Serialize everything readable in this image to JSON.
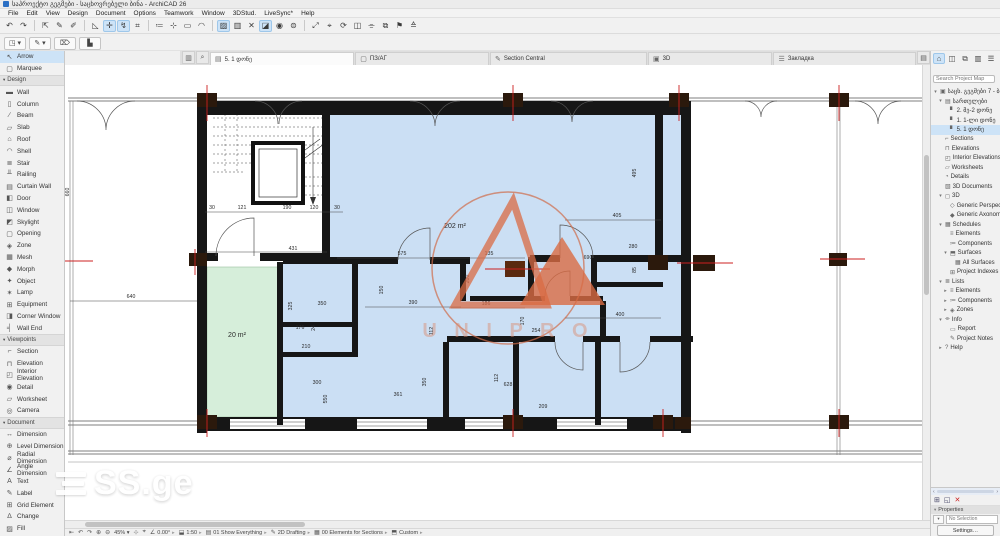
{
  "window": {
    "title": "საპროექტო გეგმები - საცხოვრებელი ბინა - ArchiCAD 26",
    "menus": [
      "File",
      "Edit",
      "View",
      "Design",
      "Document",
      "Options",
      "Teamwork",
      "Window",
      "3DStud.",
      "LiveSync*",
      "Help"
    ]
  },
  "toolbar": {
    "icons": [
      {
        "g": "↶"
      },
      {
        "g": "↷"
      },
      {
        "sep": true
      },
      {
        "g": "⇱"
      },
      {
        "g": "✎"
      },
      {
        "g": "✐"
      },
      {
        "sep": true
      },
      {
        "g": "◺"
      },
      {
        "g": "✛",
        "hl": true
      },
      {
        "g": "↯",
        "hl": true
      },
      {
        "g": "⌗"
      },
      {
        "sep": true
      },
      {
        "g": "≔"
      },
      {
        "g": "⊹"
      },
      {
        "g": "▭"
      },
      {
        "g": "◠"
      },
      {
        "sep": true
      },
      {
        "g": "▨",
        "hl": true
      },
      {
        "g": "▥"
      },
      {
        "g": "✕"
      },
      {
        "g": "◪",
        "hl": true
      },
      {
        "g": "◉"
      },
      {
        "g": "⊜"
      },
      {
        "sep": true
      },
      {
        "g": "⤢"
      },
      {
        "g": "⌖"
      },
      {
        "g": "⟳"
      },
      {
        "g": "◫"
      },
      {
        "g": "⌯"
      },
      {
        "g": "⧉"
      },
      {
        "g": "⚑"
      },
      {
        "g": "≙"
      }
    ]
  },
  "row2": {
    "buttons": [
      "◳ ▾",
      "✎ ▾",
      "⌦",
      "▙"
    ]
  },
  "tabbar": {
    "tabs": [
      {
        "icon": "▤",
        "label": "5. 1 დონე",
        "active": true
      },
      {
        "icon": "▢",
        "label": "ПЗ/АГ",
        "active": false
      },
      {
        "icon": "✎",
        "label": "Section Central",
        "active": false
      },
      {
        "icon": "▣",
        "label": "3D",
        "active": false
      },
      {
        "icon": "☰",
        "label": "Закладка",
        "active": false
      }
    ]
  },
  "toolbox": {
    "groups": [
      {
        "header": null,
        "items": [
          {
            "label": "Arrow",
            "icon": "↖",
            "selected": true
          },
          {
            "label": "Marquee",
            "icon": "▢",
            "selected": false
          }
        ]
      },
      {
        "header": "Design",
        "items": [
          {
            "label": "Wall",
            "icon": "▬"
          },
          {
            "label": "Column",
            "icon": "▯"
          },
          {
            "label": "Beam",
            "icon": "∕"
          },
          {
            "label": "Slab",
            "icon": "▱"
          },
          {
            "label": "Roof",
            "icon": "⌂"
          },
          {
            "label": "Shell",
            "icon": "◠"
          },
          {
            "label": "Stair",
            "icon": "≣"
          },
          {
            "label": "Railing",
            "icon": "╨"
          },
          {
            "label": "Curtain Wall",
            "icon": "▤"
          },
          {
            "label": "Door",
            "icon": "◧"
          },
          {
            "label": "Window",
            "icon": "◫"
          },
          {
            "label": "Skylight",
            "icon": "◩"
          },
          {
            "label": "Opening",
            "icon": "▢"
          },
          {
            "label": "Zone",
            "icon": "◈"
          },
          {
            "label": "Mesh",
            "icon": "▦"
          },
          {
            "label": "Morph",
            "icon": "◆"
          },
          {
            "label": "Object",
            "icon": "✦"
          },
          {
            "label": "Lamp",
            "icon": "✶"
          },
          {
            "label": "Equipment",
            "icon": "⊞"
          },
          {
            "label": "Corner Window",
            "icon": "◨"
          },
          {
            "label": "Wall End",
            "icon": "╡"
          }
        ]
      },
      {
        "header": "Viewpoints",
        "items": [
          {
            "label": "Section",
            "icon": "⌐"
          },
          {
            "label": "Elevation",
            "icon": "⊓"
          },
          {
            "label": "Interior Elevation",
            "icon": "◰"
          },
          {
            "label": "Detail",
            "icon": "◉"
          },
          {
            "label": "Worksheet",
            "icon": "▱"
          },
          {
            "label": "Camera",
            "icon": "◎"
          }
        ]
      },
      {
        "header": "Document",
        "items": [
          {
            "label": "Dimension",
            "icon": "↔"
          },
          {
            "label": "Level Dimension",
            "icon": "⊕"
          },
          {
            "label": "Radial Dimension",
            "icon": "⌀"
          },
          {
            "label": "Angle Dimension",
            "icon": "∠"
          },
          {
            "label": "Text",
            "icon": "A"
          },
          {
            "label": "Label",
            "icon": "✎"
          },
          {
            "label": "Grid Element",
            "icon": "⊞"
          },
          {
            "label": "Change",
            "icon": "∆"
          },
          {
            "label": "Fill",
            "icon": "▨"
          }
        ]
      }
    ]
  },
  "navigator": {
    "search_placeholder": "Search Project Map",
    "icons": [
      "⌂",
      "◫",
      "⧉",
      "▥",
      "☰"
    ],
    "tree": [
      {
        "t": "საცხ. გეგმები 7 - ბინა",
        "l": 0,
        "e": "▾",
        "i": "▣"
      },
      {
        "t": "სართულები",
        "l": 1,
        "e": "▾",
        "i": "▤"
      },
      {
        "t": "2. მე-2 დონე",
        "l": 2,
        "e": "",
        "i": "▘"
      },
      {
        "t": "1. 1-ლი დონე",
        "l": 2,
        "e": "",
        "i": "▘"
      },
      {
        "t": "5. 1 დონე",
        "l": 2,
        "e": "",
        "i": "▘",
        "sel": true
      },
      {
        "t": "Sections",
        "l": 1,
        "e": "",
        "i": "⌐"
      },
      {
        "t": "Elevations",
        "l": 1,
        "e": "",
        "i": "⊓"
      },
      {
        "t": "Interior Elevations",
        "l": 1,
        "e": "",
        "i": "◰"
      },
      {
        "t": "Worksheets",
        "l": 1,
        "e": "",
        "i": "▱"
      },
      {
        "t": "Details",
        "l": 1,
        "e": "",
        "i": "◔"
      },
      {
        "t": "3D Documents",
        "l": 1,
        "e": "",
        "i": "▧"
      },
      {
        "t": "3D",
        "l": 1,
        "e": "▾",
        "i": "◻"
      },
      {
        "t": "Generic Perspective",
        "l": 2,
        "e": "",
        "i": "◇"
      },
      {
        "t": "Generic Axonometry",
        "l": 2,
        "e": "",
        "i": "◆"
      },
      {
        "t": "Schedules",
        "l": 1,
        "e": "▾",
        "i": "▦"
      },
      {
        "t": "Elements",
        "l": 2,
        "e": "",
        "i": "≡"
      },
      {
        "t": "Components",
        "l": 2,
        "e": "",
        "i": "≔"
      },
      {
        "t": "Surfaces",
        "l": 2,
        "e": "▾",
        "i": "⬒"
      },
      {
        "t": "All Surfaces",
        "l": 3,
        "e": "",
        "i": "▦"
      },
      {
        "t": "Project Indexes",
        "l": 2,
        "e": "",
        "i": "⊞"
      },
      {
        "t": "Lists",
        "l": 1,
        "e": "▾",
        "i": "≣"
      },
      {
        "t": "Elements",
        "l": 2,
        "e": "▸",
        "i": "≡"
      },
      {
        "t": "Components",
        "l": 2,
        "e": "▸",
        "i": "≔"
      },
      {
        "t": "Zones",
        "l": 2,
        "e": "▸",
        "i": "◈"
      },
      {
        "t": "Info",
        "l": 1,
        "e": "▾",
        "i": "⌯"
      },
      {
        "t": "Report",
        "l": 2,
        "e": "",
        "i": "▭"
      },
      {
        "t": "Project Notes",
        "l": 2,
        "e": "",
        "i": "✎"
      },
      {
        "t": "Help",
        "l": 1,
        "e": "▸",
        "i": "?"
      }
    ]
  },
  "side_panel": {
    "icons": [
      "⊞",
      "◱",
      "✕"
    ],
    "header": "Properties",
    "field": "No Selection",
    "button": "Settings…"
  },
  "statusbar": {
    "nav_icons": [
      "⇤",
      "↶",
      "↷",
      "⊕",
      "⊖"
    ],
    "zoom": "45%",
    "mid_icons": [
      "⊹",
      "⌖"
    ],
    "segments": [
      {
        "icon": "∠",
        "label": "0.00°"
      },
      {
        "icon": "⬓",
        "label": "1:50"
      },
      {
        "icon": "▤",
        "label": "01 Show Everything"
      },
      {
        "icon": "✎",
        "label": "2D Drafting"
      },
      {
        "icon": "▦",
        "label": "00 Elements for Sections"
      },
      {
        "icon": "⬒",
        "label": "Custom"
      }
    ]
  },
  "watermarks": {
    "logo_text": "SS.ge",
    "circle_text": "U N I  P R O"
  },
  "plan": {
    "room_colors": {
      "blue": "#cbdff4",
      "green": "#d6eeda"
    },
    "dims": [
      {
        "t": "660",
        "x": 4,
        "y": 127,
        "r": 1
      },
      {
        "t": "640",
        "x": 66,
        "y": 233
      },
      {
        "t": "30",
        "x": 147,
        "y": 144
      },
      {
        "t": "121",
        "x": 177,
        "y": 144
      },
      {
        "t": "190",
        "x": 222,
        "y": 144
      },
      {
        "t": "120",
        "x": 249,
        "y": 144
      },
      {
        "t": "30",
        "x": 272,
        "y": 144
      },
      {
        "t": "431",
        "x": 228,
        "y": 185
      },
      {
        "t": "575",
        "x": 337,
        "y": 190
      },
      {
        "t": "135",
        "x": 424,
        "y": 190
      },
      {
        "t": "202 m²",
        "x": 390,
        "y": 163,
        "s": 7
      },
      {
        "t": "495",
        "x": 571,
        "y": 108,
        "r": 1
      },
      {
        "t": "405",
        "x": 552,
        "y": 152
      },
      {
        "t": "690",
        "x": 523,
        "y": 194
      },
      {
        "t": "280",
        "x": 568,
        "y": 183
      },
      {
        "t": "85",
        "x": 571,
        "y": 205,
        "r": 1
      },
      {
        "t": "200",
        "x": 404,
        "y": 214,
        "r": 1
      },
      {
        "t": "186",
        "x": 421,
        "y": 240
      },
      {
        "t": "170",
        "x": 459,
        "y": 256,
        "r": 1
      },
      {
        "t": "254",
        "x": 471,
        "y": 267
      },
      {
        "t": "400",
        "x": 555,
        "y": 251
      },
      {
        "t": "150",
        "x": 318,
        "y": 225,
        "r": 1
      },
      {
        "t": "390",
        "x": 348,
        "y": 239
      },
      {
        "t": "325",
        "x": 227,
        "y": 241,
        "r": 1
      },
      {
        "t": "350",
        "x": 257,
        "y": 240
      },
      {
        "t": "176",
        "x": 235,
        "y": 264
      },
      {
        "t": "24",
        "x": 250,
        "y": 263,
        "r": 1
      },
      {
        "t": "210",
        "x": 241,
        "y": 283
      },
      {
        "t": "112",
        "x": 368,
        "y": 266,
        "r": 1
      },
      {
        "t": "300",
        "x": 252,
        "y": 319
      },
      {
        "t": "550",
        "x": 262,
        "y": 334,
        "r": 1
      },
      {
        "t": "361",
        "x": 333,
        "y": 331
      },
      {
        "t": "350",
        "x": 361,
        "y": 317,
        "r": 1
      },
      {
        "t": "112",
        "x": 433,
        "y": 313,
        "r": 1
      },
      {
        "t": "628",
        "x": 443,
        "y": 321
      },
      {
        "t": "209",
        "x": 478,
        "y": 343
      },
      {
        "t": "20 m²",
        "x": 172,
        "y": 272,
        "s": 7
      }
    ]
  }
}
